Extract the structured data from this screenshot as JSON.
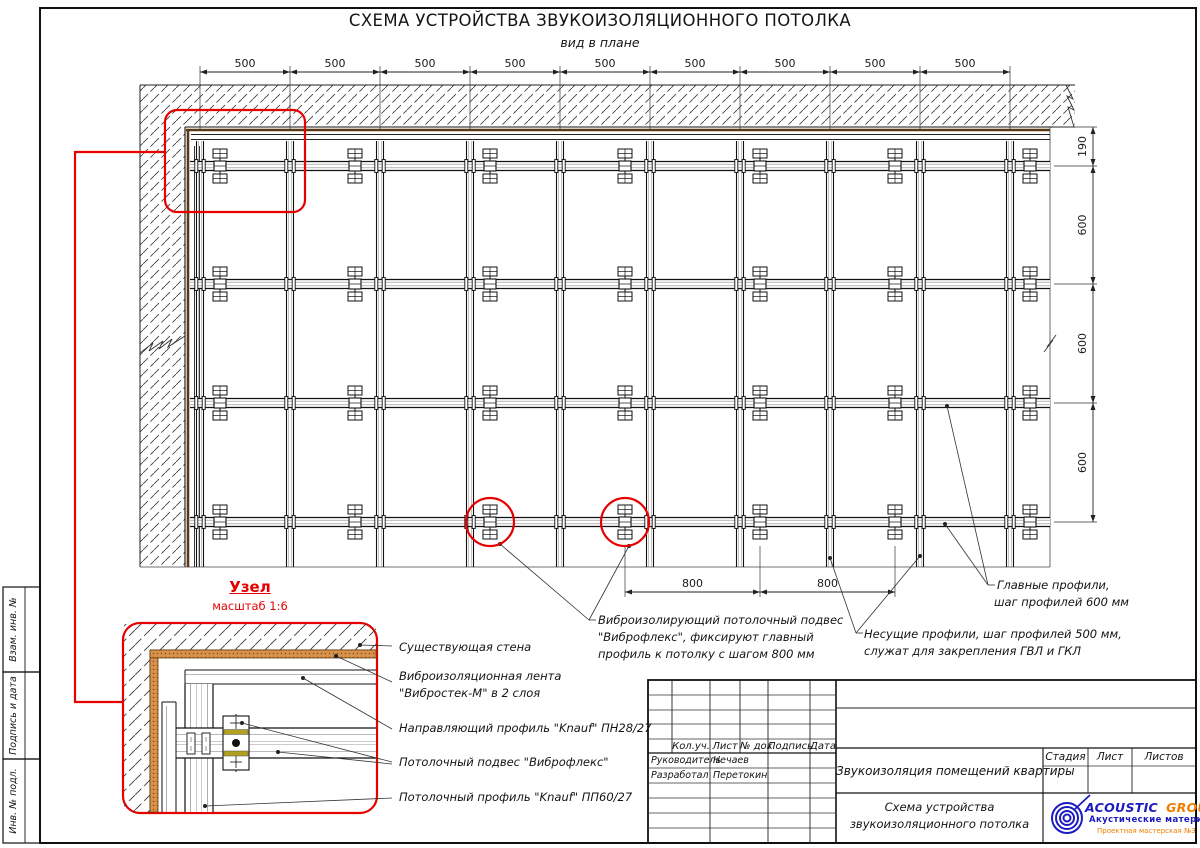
{
  "title": {
    "main": "СХЕМА УСТРОЙСТВА ЗВУКОИЗОЛЯЦИОННОГО ПОТОЛКА",
    "sub": "вид в плане"
  },
  "dimensions": {
    "top": [
      "500",
      "500",
      "500",
      "500",
      "500",
      "500",
      "500",
      "500",
      "500"
    ],
    "right": [
      "190",
      "600",
      "600",
      "600"
    ],
    "bottom": [
      "800",
      "800"
    ]
  },
  "notes": {
    "hanger": [
      "Виброизолирующий потолочный подвес",
      "\"Виброфлекс\", фиксируют главный",
      "профиль к потолку с шагом 800 мм"
    ],
    "carrier": [
      "Несущие профили, шаг профилей 500 мм,",
      "служат для закрепления ГВЛ и ГКЛ"
    ],
    "main_profile": [
      "Главные профили,",
      "шаг профилей 600 мм"
    ]
  },
  "detail": {
    "title": "Узел",
    "scale": "масштаб 1:6",
    "labels": {
      "wall": "Существующая стена",
      "tape1": "Виброизоляционная лента",
      "tape2": "\"Вибростек-М\" в 2 слоя",
      "guide": "Направляющий профиль \"Knauf\" ПН28/27",
      "hanger": "Потолочный подвес \"Виброфлекс\"",
      "profile": "Потолочный профиль \"Knauf\" ПП60/27"
    }
  },
  "sidebar": {
    "labels": [
      "Взам. инв. №",
      "Подпись и дата",
      "Инв. № подл."
    ]
  },
  "titleblock": {
    "header": [
      "Кол.уч.",
      "Лист",
      "№ док",
      "Подпись",
      "Дата"
    ],
    "roles": [
      {
        "role": "Руководитель",
        "name": "Нечаев"
      },
      {
        "role": "Разработал",
        "name": "Перетокин"
      }
    ],
    "project": "Звукоизоляция помещений квартиры",
    "sheet_title1": "Схема устройства",
    "sheet_title2": "звукоизоляционного потолка",
    "stage_header": [
      "Стадия",
      "Лист",
      "Листов"
    ],
    "logo": {
      "name1": "ACOUSTIC",
      "name2": "GROUP",
      "tagline": "Акустические материалы",
      "sub": "Проектная мастерская №3"
    }
  },
  "colors": {
    "red": "#e60000",
    "tape": "#d8924a",
    "tape_dark": "#5a3a14",
    "pad": "#b2a020",
    "logo_blue": "#1b1bbf",
    "logo_orange": "#f07d00"
  }
}
